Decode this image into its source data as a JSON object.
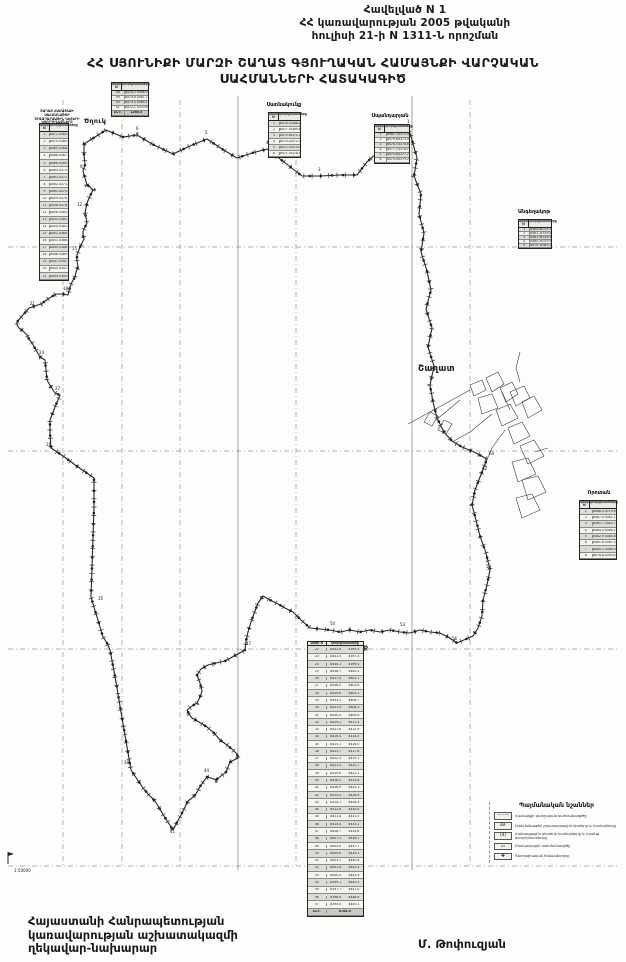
{
  "header": {
    "text": "Հավելված N 1\nՀՀ կառավարության 2005 թվականի\nհուլիսի 21-ի N 1311-Ն որոշման"
  },
  "title": {
    "text": "ՀՀ ՍՅՈՒՆԻՔԻ ՄԱՐԶԻ ՇԱՂԱՏ ԳՅՈՒՂԱԿԱՆ ՀԱՄԱՅՆՔԻ ՎԱՐՉԱԿԱՆ\nՍԱՀՄԱՆՆԵՐԻ ՀԱՏԱԿԱԳԻԾ"
  },
  "map": {
    "labels": {
      "tsghuk": "Ծղուկ",
      "shaghat": "Շաղատ",
      "mutsk": "Մուցք"
    },
    "boundary": "84,144 106,130 123,137 137,135 152,144 173,154 190,146 207,139 222,149 237,158 252,153 267,149 284,162 302,176 320,176 340,175 357,175 367,162 380,150 395,138 408,127 412,140 417,158 414,176 421,194 419,214 424,233 421,252 427,271 431,290 426,309 432,328 428,347 434,366 430,385 433,402 437,418 444,432 452,441 462,447 474,452 487,459 482,472 475,490 472,505 476,520 480,536 486,553 490,570 487,585 483,600 482,616 478,628 473,636 457,643 448,637 440,633 430,632 420,630 410,633 400,632 390,630 380,632 370,630 360,632 350,630 340,632 330,630 320,629 310,628 301,620 293,612 285,608 278,604 270,600 263,596 258,603 255,611 251,622 248,632 246,641 245,650 236,655 225,661 216,663 208,665 201,669 197,675 200,683 202,691 200,697 197,703 192,706 187,710 189,714 192,718 199,722 207,727 214,733 220,740 227,745 233,750 237,754 238,758 234,760 230,762 228,767 226,772 221,776 216,780 211,778 207,777 201,785 196,794 192,798 188,801 181,815 173,830 164,816 155,801 149,795 143,788 137,779 131,770 126,741 121,712 116,682 110,650 107,643 103,637 97,617 91,597 92,567 93,537 94,507 94,478 78,467 63,456 57,452 51,448 50,434 50,420 55,407 60,395 57,394 55,393 51,387 47,380 46,370 45,360 42,358 40,357 36,350 32,343 29,339 27,335 23,331 19,328 17,325 17,322 23,315 29,308 35,306 41,304 48,299 56,294 62,294 68,295 69,291 70,287 72,282 75,277 76,272 78,267 77,261 77,255 80,247 84,239 83,235 83,231 85,227 87,223 86,218 85,213 86,208 87,203 90,196 93,190 90,187 87,185 85,178 83,171 84,168 85,165 84,155 84,144",
    "point_labels": [
      [
        "1",
        407,
        123
      ],
      [
        "2",
        378,
        148
      ],
      [
        "3",
        318,
        171
      ],
      [
        "4",
        266,
        144
      ],
      [
        "5",
        205,
        134
      ],
      [
        "6",
        136,
        130
      ],
      [
        "7",
        103,
        125
      ],
      [
        "9",
        80,
        168
      ],
      [
        "12",
        77,
        206
      ],
      [
        "15",
        72,
        250
      ],
      [
        "18",
        63,
        290
      ],
      [
        "21",
        30,
        305
      ],
      [
        "24",
        39,
        354
      ],
      [
        "27",
        55,
        390
      ],
      [
        "31",
        46,
        446
      ],
      [
        "35",
        98,
        600
      ],
      [
        "38",
        124,
        764
      ],
      [
        "41",
        170,
        833
      ],
      [
        "44",
        204,
        772
      ],
      [
        "47",
        246,
        645
      ],
      [
        "50",
        330,
        625
      ],
      [
        "53",
        400,
        626
      ],
      [
        "56",
        452,
        640
      ],
      [
        "59",
        486,
        568
      ],
      [
        "62",
        482,
        470
      ],
      [
        "64",
        489,
        455
      ]
    ]
  },
  "tables": {
    "left": {
      "title": "ՇԱՂԱՏ ՀԱՄԱՅՆՔԻ ՍԱՀՄԱՆԱԳԾԻ\nՇՐՋԱԴԱՐՁԱՅԻՆ ԿԵՏԵՐԻ\nԿՈՈՐԴԻՆԱՏՆԵՐԸ",
      "col1": "կետի N",
      "col2": "կոորդինատները",
      "rows": [
        [
          "1",
          "8472.4",
          "4363.1"
        ],
        [
          "2",
          "8470.9",
          "4364.8"
        ],
        [
          "3",
          "8469.5",
          "4366.2"
        ],
        [
          "4",
          "8468.1",
          "4367.9"
        ],
        [
          "5",
          "8466.8",
          "4369.4"
        ],
        [
          "6",
          "8465.2",
          "4370.6"
        ],
        [
          "7",
          "8463.9",
          "4372.3"
        ],
        [
          "8",
          "8462.5",
          "4373.8"
        ],
        [
          "9",
          "8461.0",
          "4375.2"
        ],
        [
          "10",
          "8459.6",
          "4376.9"
        ],
        [
          "11",
          "8458.3",
          "4378.4"
        ],
        [
          "12",
          "8456.8",
          "4380.1"
        ],
        [
          "13",
          "8455.4",
          "4381.6"
        ],
        [
          "14",
          "8454.1",
          "4383.2"
        ],
        [
          "15",
          "8452.7",
          "4384.9"
        ],
        [
          "16",
          "8451.2",
          "4386.3"
        ],
        [
          "17",
          "8449.8",
          "4388.0"
        ],
        [
          "18",
          "8448.5",
          "4389.5"
        ],
        [
          "19",
          "8447.1",
          "4391.2"
        ],
        [
          "20",
          "8445.6",
          "4392.8"
        ],
        [
          "21",
          "8444.2",
          "4394.3"
        ]
      ]
    },
    "top_small": {
      "col1": "կետի N",
      "col2": "կոորդինատները",
      "rows": [
        [
          "48",
          "8476.2",
          "4366.0"
        ],
        [
          "49",
          "8474.8",
          "4367.7"
        ],
        [
          "50",
          "8473.5",
          "4369.1"
        ],
        [
          "51",
          "8472.1",
          "4370.6"
        ],
        [
          "ԸՆԴ.",
          "1260.5"
        ]
      ]
    },
    "sarnakunk": {
      "title": "Սառնակունք",
      "col1": "կետի N",
      "col2": "կոորդինատները",
      "rows": [
        [
          "1",
          "8478.3",
          "4368.2"
        ],
        [
          "2",
          "8477.0",
          "4369.8"
        ],
        [
          "3",
          "8475.6",
          "4371.3"
        ],
        [
          "4",
          "8474.2",
          "4372.9"
        ],
        [
          "5",
          "8472.9",
          "4374.4"
        ],
        [
          "6",
          "8471.5",
          "4376.0"
        ]
      ]
    },
    "spandaryan": {
      "title": "Սպանդարյան",
      "col1": "կետի N",
      "col2": "կոորդինատները",
      "rows": [
        [
          "1",
          "8481.2",
          "4371.4"
        ],
        [
          "2",
          "8479.8",
          "4373.0"
        ],
        [
          "3",
          "8478.5",
          "4374.6"
        ],
        [
          "4",
          "8477.1",
          "4376.1"
        ],
        [
          "5",
          "8475.8",
          "4377.7"
        ],
        [
          "6",
          "8474.4",
          "4379.2"
        ]
      ]
    },
    "angeghakot": {
      "title": "Անգեղակոթ",
      "col1": "կետի N",
      "col2": "կոորդինատները",
      "rows": [
        [
          "1",
          "8484.6",
          "4375.3"
        ],
        [
          "2",
          "8483.2",
          "4376.8"
        ],
        [
          "3",
          "8481.9",
          "4378.4"
        ],
        [
          "4",
          "8480.5",
          "4379.9"
        ],
        [
          "5",
          "8479.1",
          "4381.5"
        ]
      ]
    },
    "vorotan": {
      "title": "Որոտան",
      "col1": "կետի N",
      "col2": "կոորդինատները",
      "rows": [
        [
          "1",
          "8488.4",
          "4379.6"
        ],
        [
          "2",
          "8487.0",
          "4381.1"
        ],
        [
          "3",
          "8485.7",
          "4382.7"
        ],
        [
          "4",
          "8484.3",
          "4384.2"
        ],
        [
          "5",
          "8482.9",
          "4385.8"
        ],
        [
          "6",
          "8481.6",
          "4387.3"
        ],
        [
          "7",
          "8480.2",
          "4388.9"
        ],
        [
          "8",
          "8478.8",
          "4390.4"
        ]
      ]
    },
    "bottom": {
      "col1": "կետի N",
      "col2": "կոորդինատները",
      "rows": [
        [
          "22",
          "8442.8",
          "4395.9"
        ],
        [
          "23",
          "8441.5",
          "4397.4"
        ],
        [
          "24",
          "8440.1",
          "4399.0"
        ],
        [
          "25",
          "8438.7",
          "4400.5"
        ],
        [
          "26",
          "8437.4",
          "4402.1"
        ],
        [
          "27",
          "8436.0",
          "4403.6"
        ],
        [
          "28",
          "8434.6",
          "4405.2"
        ],
        [
          "29",
          "8433.3",
          "4406.7"
        ],
        [
          "30",
          "8431.9",
          "4408.3"
        ],
        [
          "31",
          "8430.5",
          "4409.8"
        ],
        [
          "32",
          "8429.2",
          "4411.4"
        ],
        [
          "33",
          "8427.8",
          "4412.9"
        ],
        [
          "34",
          "8426.4",
          "4414.5"
        ],
        [
          "35",
          "8425.1",
          "4416.0"
        ],
        [
          "36",
          "8423.7",
          "4417.6"
        ],
        [
          "37",
          "8422.3",
          "4419.1"
        ],
        [
          "38",
          "8421.0",
          "4420.7"
        ],
        [
          "39",
          "8419.6",
          "4422.2"
        ],
        [
          "40",
          "8418.2",
          "4423.8"
        ],
        [
          "41",
          "8416.9",
          "4425.3"
        ],
        [
          "42",
          "8415.5",
          "4426.9"
        ],
        [
          "43",
          "8414.1",
          "4428.4"
        ],
        [
          "44",
          "8412.8",
          "4430.0"
        ],
        [
          "45",
          "8411.4",
          "4431.5"
        ],
        [
          "46",
          "8410.0",
          "4433.1"
        ],
        [
          "47",
          "8408.7",
          "4434.6"
        ],
        [
          "48",
          "8407.3",
          "4436.2"
        ],
        [
          "49",
          "8405.9",
          "4437.7"
        ],
        [
          "50",
          "8404.6",
          "4439.3"
        ],
        [
          "51",
          "8403.2",
          "4440.8"
        ],
        [
          "52",
          "8401.8",
          "4442.4"
        ],
        [
          "53",
          "8400.5",
          "4443.9"
        ],
        [
          "54",
          "8399.1",
          "4445.5"
        ],
        [
          "55",
          "8397.7",
          "4447.0"
        ],
        [
          "56",
          "8396.4",
          "4448.6"
        ],
        [
          "57",
          "8395.0",
          "4450.1"
        ],
        [
          "ԸՆԴ.",
          "6764.0"
        ]
      ]
    }
  },
  "legend": {
    "title": "Պայմանական նշաններ",
    "items": [
      {
        "symbol": "—··—",
        "label": "Համայնքի վարչական սահմանագիծը"
      },
      {
        "symbol": "38·",
        "label": "Սահմանագծի շրջադարձային կետերը և համարները"
      },
      {
        "symbol": "(4)",
        "label": "Հանգուցային կետերի համարները և դրանց կոորդինատները"
      },
      {
        "symbol": "▭",
        "label": "Բնակավայրի սահմանագիծը"
      },
      {
        "symbol": "✚",
        "label": "Գեոդեզիական հենակետերը"
      }
    ]
  },
  "scale_mark": "1:50000",
  "footer": {
    "left": "Հայաստանի Հանրապետության\nկառավարության աշխատակազմի\nղեկավար-նախարար",
    "signer": "Մ. Թոփուզյան"
  }
}
